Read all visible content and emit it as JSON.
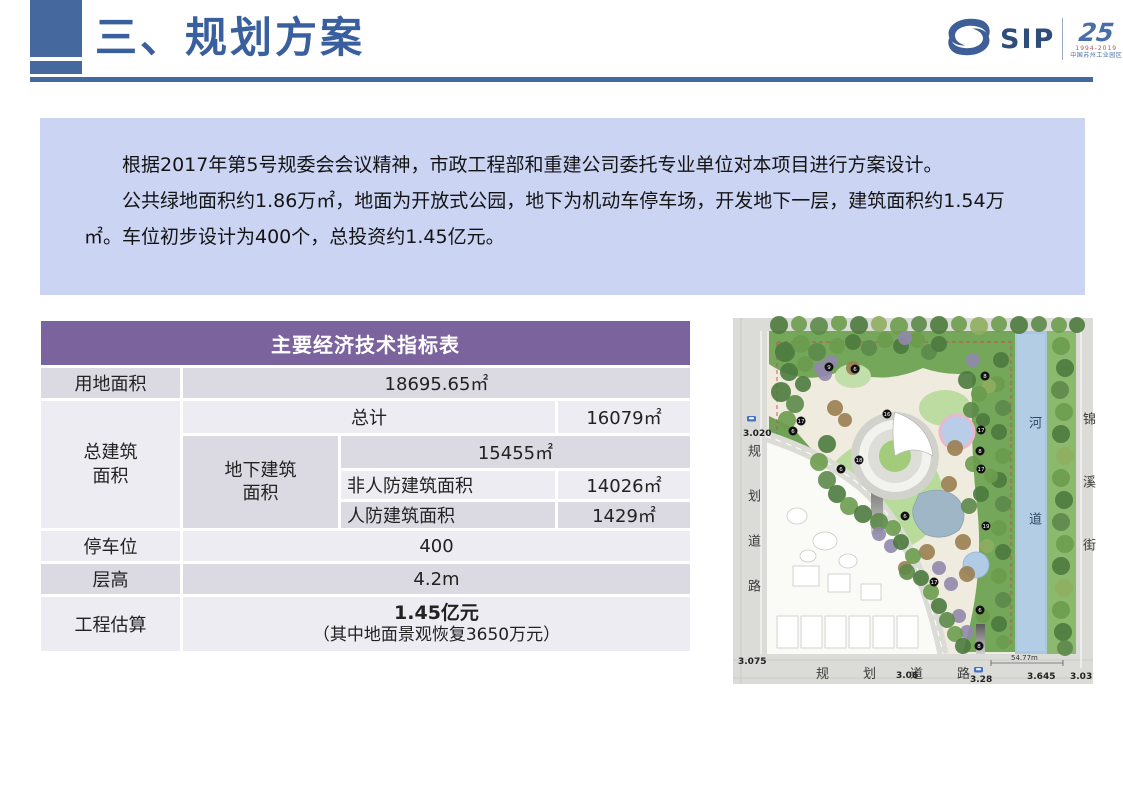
{
  "slide": {
    "title": "三、规划方案"
  },
  "logo": {
    "sip_text": "SIP",
    "anniversary_number": "25",
    "anniversary_years": "1994-2019",
    "anniversary_caption": "中国苏州工业园区"
  },
  "intro": {
    "paragraph1": "根据2017年第5号规委会会议精神，市政工程部和重建公司委托专业单位对本项目进行方案设计。",
    "paragraph2": "公共绿地面积约1.86万㎡，地面为开放式公园，地下为机动车停车场，开发地下一层，建筑面积约1.54万㎡。车位初步设计为400个，总投资约1.45亿元。"
  },
  "table": {
    "title": "主要经济技术指标表",
    "land_area_label": "用地面积",
    "land_area_value": "18695.65㎡",
    "total_floor_label": "总建筑面积",
    "total_label": "总计",
    "total_value": "16079㎡",
    "underground_label": "地下建筑面积",
    "underground_total_value": "15455㎡",
    "non_civil_defense_label": "非人防建筑面积",
    "non_civil_defense_value": "14026㎡",
    "civil_defense_label": "人防建筑面积",
    "civil_defense_value": "1429㎡",
    "parking_label": "停车位",
    "parking_value": "400",
    "floor_height_label": "层高",
    "floor_height_value": "4.2m",
    "estimate_label": "工程估算",
    "estimate_value": "1.45亿元",
    "estimate_note": "（其中地面景观恢复3650万元）"
  },
  "site_plan": {
    "river_label": "河道",
    "street_label": "锦溪街",
    "left_road_label": "规划道路",
    "bottom_road_label": "规划道路",
    "elevations": {
      "left_top": "3.020",
      "left_bottom": "3.075",
      "bottom_1": "3.06",
      "bottom_2": "3.28",
      "bottom_3": "3.645",
      "bottom_4": "3.03"
    },
    "dimension_label": "54.77m",
    "markers": [
      "9",
      "6",
      "8",
      "16",
      "17",
      "6",
      "17",
      "8",
      "18",
      "6",
      "17",
      "6",
      "19",
      "17",
      "6",
      "8"
    ]
  }
}
